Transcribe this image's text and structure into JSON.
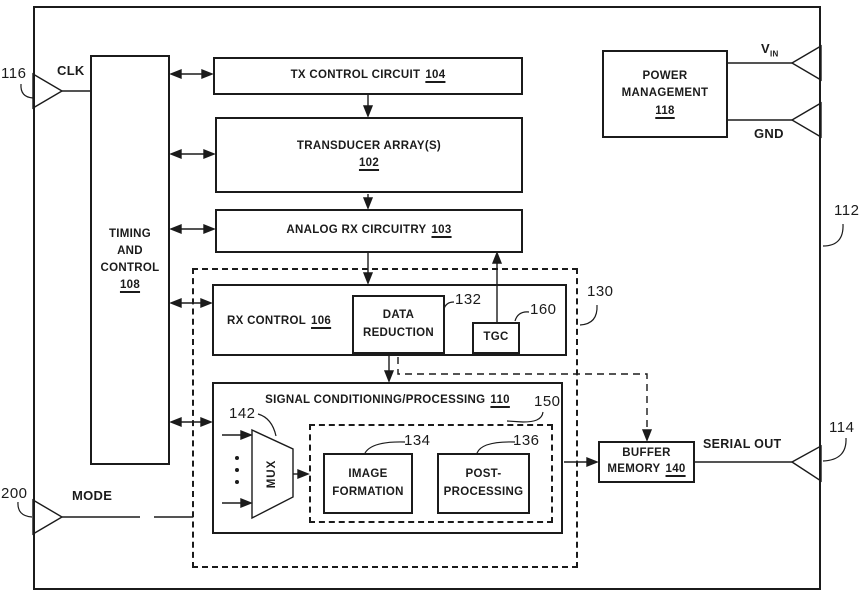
{
  "blocks": {
    "timing": {
      "line1": "TIMING",
      "line2": "AND",
      "line3": "CONTROL",
      "ref": "108"
    },
    "tx_control": {
      "label": "TX CONTROL CIRCUIT",
      "ref": "104"
    },
    "transducer": {
      "label": "TRANSDUCER ARRAY(S)",
      "ref": "102"
    },
    "analog_rx": {
      "label": "ANALOG RX CIRCUITRY",
      "ref": "103"
    },
    "rx_control": {
      "label": "RX CONTROL",
      "ref": "106"
    },
    "data_reduction": {
      "line1": "DATA",
      "line2": "REDUCTION",
      "ref": "132"
    },
    "tgc": {
      "label": "TGC",
      "ref": "160"
    },
    "signal_processing": {
      "label": "SIGNAL CONDITIONING/PROCESSING",
      "ref": "110"
    },
    "mux": {
      "label": "MUX",
      "ref": "142"
    },
    "image_formation": {
      "line1": "IMAGE",
      "line2": "FORMATION",
      "ref": "134"
    },
    "post_processing": {
      "line1": "POST-",
      "line2": "PROCESSING",
      "ref": "136"
    },
    "buffer_memory": {
      "line1": "BUFFER",
      "line2": "MEMORY",
      "ref": "140"
    },
    "power_management": {
      "line1": "POWER",
      "line2": "MANAGEMENT",
      "ref": "118"
    },
    "rx_subsystem": {
      "ref": "130"
    },
    "processing_subsystem": {
      "ref": "150"
    }
  },
  "ports": {
    "clk": "CLK",
    "mode": "MODE",
    "serial_out": "SERIAL OUT",
    "vin_base": "V",
    "vin_sub": "IN",
    "gnd": "GND"
  },
  "refs": {
    "chip": "112",
    "serial_link": "114",
    "clk_input": "116",
    "mode_input": "200"
  }
}
